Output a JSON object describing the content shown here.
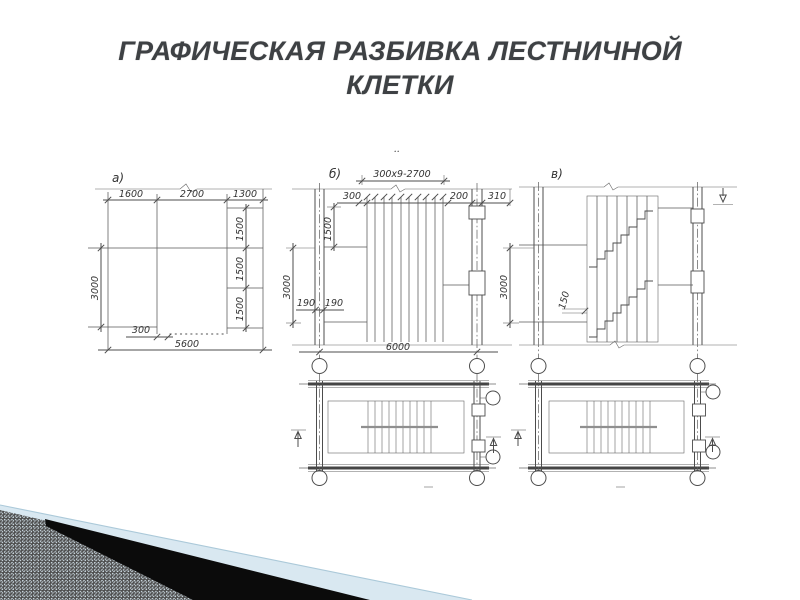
{
  "slide": {
    "title_line1": "ГРАФИЧЕСКАЯ РАЗБИВКА ЛЕСТНИЧНОЙ",
    "title_line2": "КЛЕТКИ"
  },
  "figure": {
    "panel_a": {
      "label": "а)",
      "top_dims": [
        "1600",
        "2700",
        "1300"
      ],
      "right_dims": [
        "1500",
        "1500",
        "1500"
      ],
      "left_dim": "3000",
      "bottom_small_dim": "300",
      "bottom_total_dim": "5600"
    },
    "panel_b": {
      "label": "б)",
      "dots": "..",
      "tread_dim": "300x9-2700",
      "dim_300": "300",
      "dim_200": "200",
      "dim_310": "310",
      "dim_1500": "1500",
      "dim_190_left": "190",
      "dim_190_right": "190",
      "left_dim": "3000",
      "bottom_total_dim": "6000"
    },
    "panel_v": {
      "label": "в)",
      "left_dim": "3000",
      "dim_150": "150"
    },
    "colors": {
      "drawing_line": "#4c4c4c",
      "title_gray": "#3e4144",
      "accent_blue": "#d9e8f1",
      "stripe_black": "#0b0b0b"
    }
  }
}
